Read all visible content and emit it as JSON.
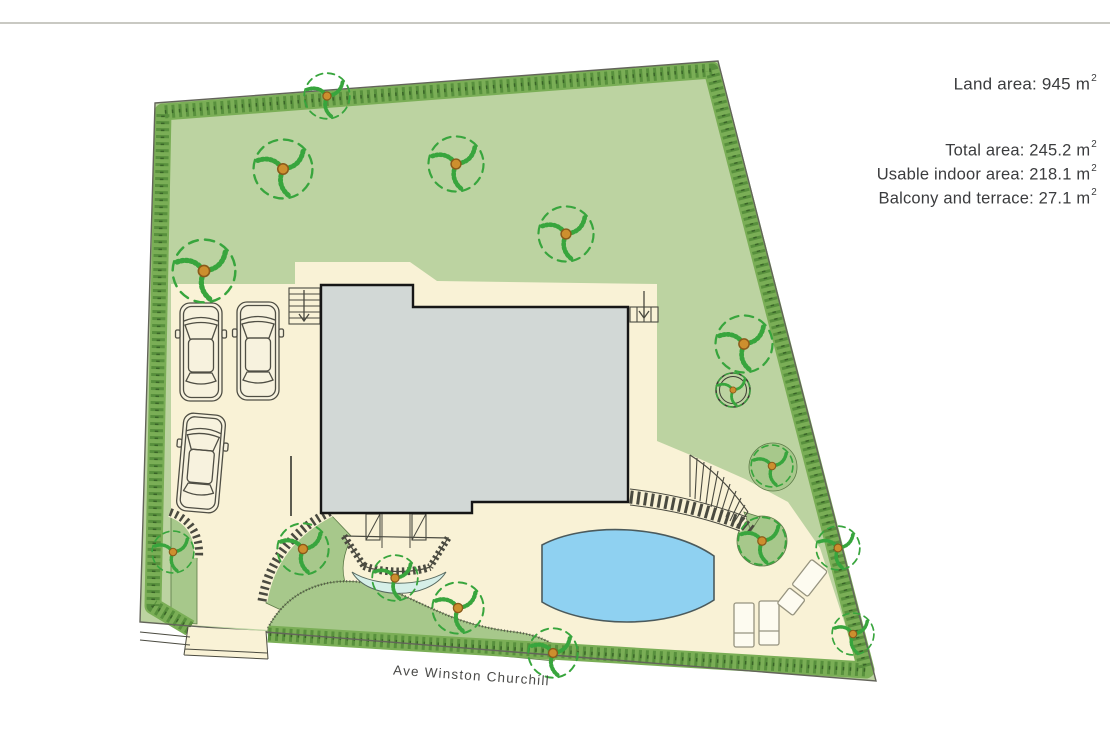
{
  "info_panel": {
    "land_area": {
      "text": "Land area: 945 m",
      "sup": "2"
    },
    "areas": [
      {
        "text": "Total area: 245.2 m",
        "sup": "2"
      },
      {
        "text": "Usable indoor area: 218.1 m",
        "sup": "2"
      },
      {
        "text": "Balcony and terrace: 27.1 m",
        "sup": "2"
      }
    ]
  },
  "street_label": "Ave Winston Churchill",
  "plan": {
    "colors": {
      "lawn": "#bcd3a1",
      "hedge": "#7aae56",
      "hedge_dark": "#478030",
      "hedge_dot": "#2c511f",
      "paved": "#f9f2d6",
      "building": "#d2d8d6",
      "pool": "#8fd1f1",
      "bed": "#a7c88b",
      "water": "#d6efe8",
      "tree": "#38a53d",
      "trunk": "#cd8f2e",
      "outline": "#63645a",
      "ink": "#3b3c3e"
    }
  }
}
